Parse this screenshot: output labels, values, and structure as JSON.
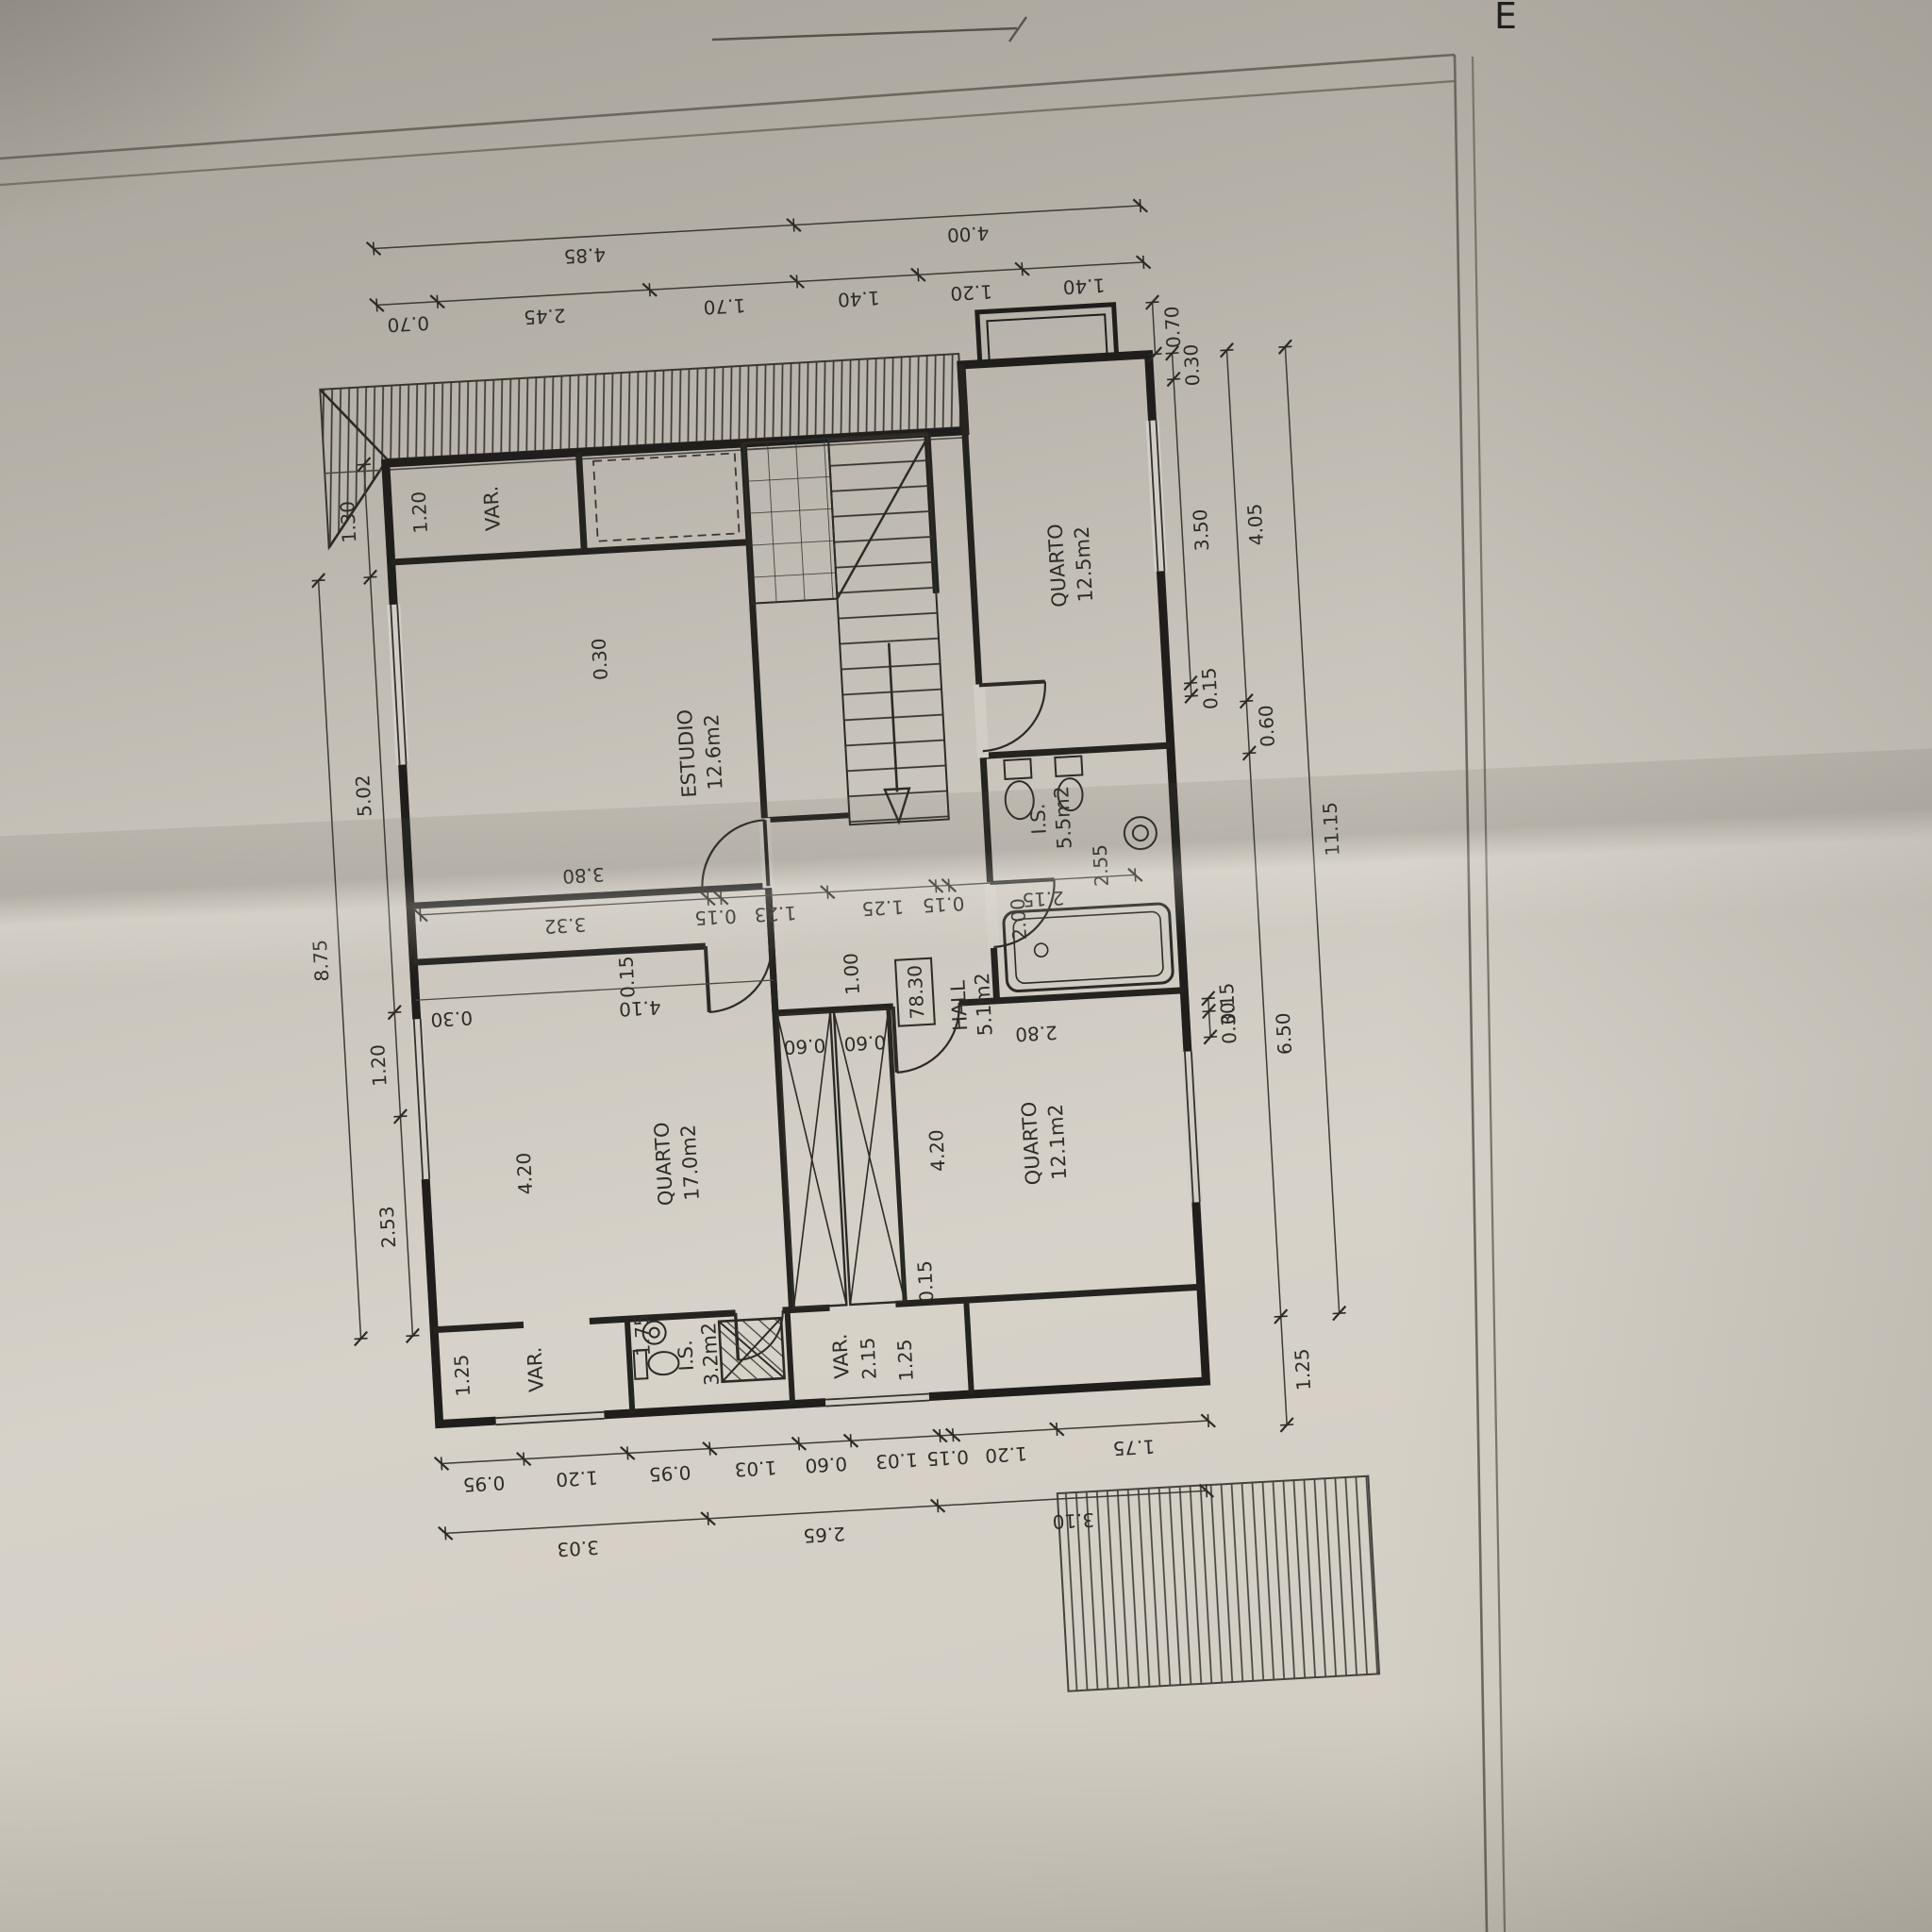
{
  "sheet": {
    "corner_letter": "E"
  },
  "rooms": {
    "estudio": {
      "name": "ESTUDIO",
      "area": "12.6m2"
    },
    "quarto_125": {
      "name": "QUARTO",
      "area": "12.5m2"
    },
    "hall": {
      "name": "HALL",
      "area": "5.1m2",
      "level": "78.30"
    },
    "is_55": {
      "name": "I.S.",
      "area": "5.5m2"
    },
    "quarto_170": {
      "name": "QUARTO",
      "area": "17.0m2"
    },
    "quarto_121": {
      "name": "QUARTO",
      "area": "12.1m2"
    },
    "is_32": {
      "name": "I.S.",
      "area": "3.2m2"
    },
    "var_top": {
      "name": "VAR."
    },
    "var_left": {
      "name": "VAR."
    },
    "var_mid": {
      "name": "VAR."
    }
  },
  "dims": {
    "top_outer": [
      "4.85",
      "4.00"
    ],
    "top_inner": [
      "0.70",
      "2.45",
      "1.70",
      "1.40",
      "1.20",
      "1.40"
    ],
    "left_inner": [
      "1.30",
      "5.02",
      "1.20",
      "2.53"
    ],
    "left_outer": [
      "8.75"
    ],
    "right_bay": "0.70",
    "right_inner": [
      "0.30",
      "3.50",
      "0.15"
    ],
    "right_inner_lower": [
      "0.15",
      "0.30"
    ],
    "right_mid": [
      "4.05",
      "0.60",
      "6.50",
      "1.25"
    ],
    "right_outer": [
      "11.15"
    ],
    "bottom_inner": [
      "0.95",
      "1.20",
      "0.95",
      "1.03",
      "0.60",
      "1.03",
      "0.15",
      "1.20",
      "1.75"
    ],
    "bottom_outer": [
      "3.03",
      "2.65",
      "3.10"
    ],
    "interior_line": [
      "3.32",
      "0.15",
      "1.23",
      "1.25",
      "0.15",
      "2.15"
    ],
    "var_top_width": "1.20",
    "estudio_top": "0.30",
    "estudio_width": "3.80",
    "hall_depth": "2.00",
    "is55_depth": "2.55",
    "door_width": "1.00",
    "q17_top": "0.15",
    "q17_wall": "0.30",
    "q17_inner_width": "4.10",
    "q17_depth": "4.20",
    "q121_inner_width": "2.80",
    "q121_depth": "4.20",
    "ward_a": "0.60",
    "ward_b": "0.60",
    "ward_wall": "0.15",
    "is32_width": "1.75",
    "var_left_width": "1.25",
    "var_mid_a": "2.15",
    "var_mid_b": "1.25"
  }
}
